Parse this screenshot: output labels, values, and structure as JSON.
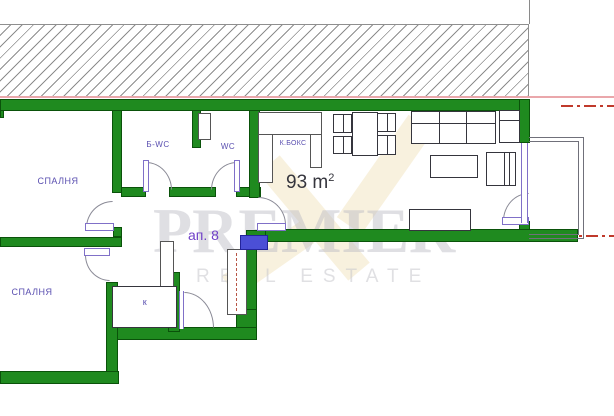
{
  "floor_plan": {
    "apartment_label": "ап. 8",
    "area_label": {
      "value": "93 m",
      "superscript": "2"
    },
    "rooms": [
      {
        "name": "bedroom-top",
        "label": "СПАЛНЯ"
      },
      {
        "name": "bathroom",
        "label": "Б-WC"
      },
      {
        "name": "toilet",
        "label": "WC"
      },
      {
        "name": "kitchen-box",
        "label": "К.БОКС"
      },
      {
        "name": "bedroom-bottom",
        "label": "СПАЛНЯ"
      },
      {
        "name": "closet",
        "label": "к"
      }
    ],
    "colors": {
      "wall_green": "#1f8a1f",
      "label_purple": "#5a4fb0",
      "apartment_purple": "#7040c8",
      "entrance_blue": "#4b4fd6",
      "axis_red": "#c0392b",
      "boundary_pink": "#eaa7ab",
      "hatch_gray": "#8d8d8d",
      "area_text": "#35353d"
    }
  },
  "watermark": {
    "brand": "PREMIER",
    "tagline": "REAL ESTATE"
  }
}
